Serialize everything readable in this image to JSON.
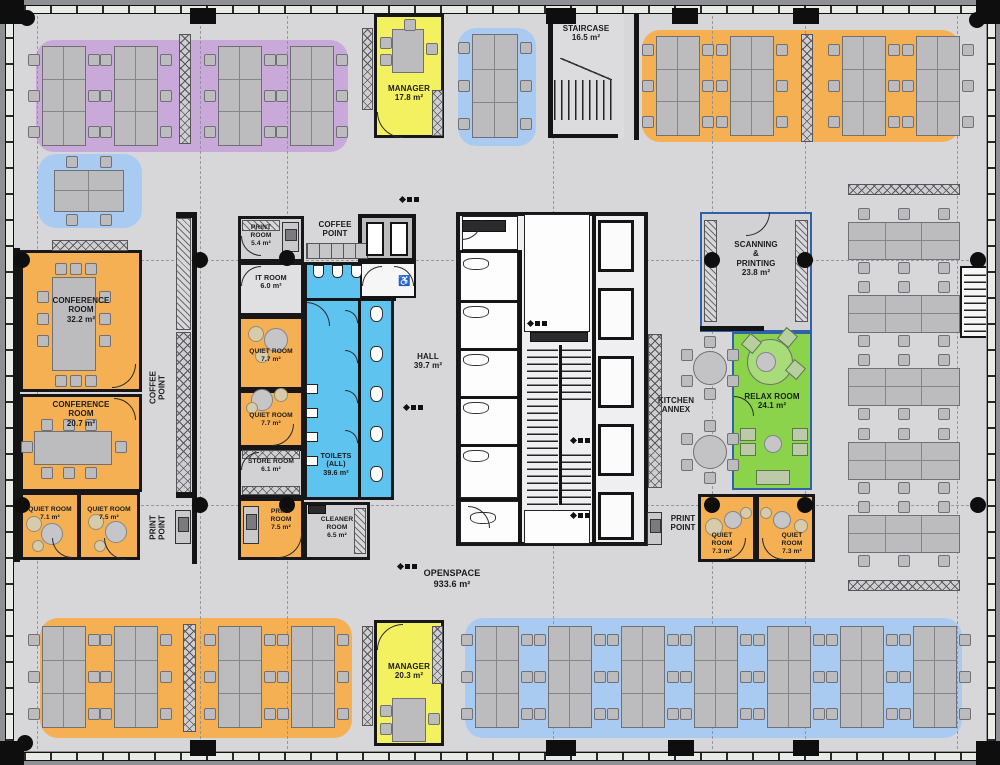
{
  "title": "Office floor plan",
  "colors": {
    "floor": "#d7d7da",
    "wall": "#141414",
    "orange": "#f5b053",
    "purple": "#c9a9da",
    "blue_zone": "#aacbf1",
    "toilet_blue": "#5ec3ee",
    "yellow": "#f4f161",
    "green": "#8bd34b",
    "desk": "#bcbcbf",
    "blue_border": "#2f62ac"
  },
  "rooms": {
    "manager_top": "MANAGER\n17.8 m²",
    "staircase": "STAIRCASE\n16.5 m²",
    "conference_1": "CONFERENCE\nROOM\n32.2 m²",
    "conference_2": "CONFERENCE\nROOM\n20.7 m²",
    "quiet_71": "QUIET ROOM\n7.1 m²",
    "quiet_75": "QUIET ROOM\n7.5 m²",
    "coffee_point_left": "COFFEE\nPOINT",
    "print_point_left": "PRINT\nPOINT",
    "print_room_top": "PRINT\nROOM\n5.4 m²",
    "coffee_point_mid": "COFFEE\nPOINT",
    "it_room": "IT ROOM\n6.0 m²",
    "quiet_77a": "QUIET ROOM\n7.7 m²",
    "quiet_77b": "QUIET ROOM\n7.7 m²",
    "store_room": "STORE ROOM\n6.1 m²",
    "print_room_mid": "PRINT\nROOM\n7.5 m²",
    "cleaner_room": "CLEANER\nROOM\n6.5 m²",
    "toilets": "TOILETS\n(ALL)\n39.6 m²",
    "hall": "HALL\n39.7 m²",
    "scanning_printing": "SCANNING\n&\nPRINTING\n23.8 m²",
    "kitchen_annex": "KITCHEN\nANNEX",
    "relax_room": "RELAX ROOM\n24.1 m²",
    "quiet_73a": "QUIET\nROOM\n7.3 m²",
    "quiet_73b": "QUIET\nROOM\n7.3 m²",
    "print_point_right": "PRINT\nPOINT",
    "openspace": "OPENSPACE\n933.6 m²",
    "manager_bottom": "MANAGER\n20.3 m²"
  },
  "zones": [
    {
      "x": 36,
      "y": 40,
      "w": 312,
      "h": 112,
      "c": "#c9a9da"
    },
    {
      "x": 38,
      "y": 154,
      "w": 104,
      "h": 74,
      "c": "#aacbf1"
    },
    {
      "x": 458,
      "y": 28,
      "w": 78,
      "h": 118,
      "c": "#aacbf1"
    },
    {
      "x": 642,
      "y": 30,
      "w": 318,
      "h": 112,
      "c": "#f5b053"
    },
    {
      "x": 40,
      "y": 618,
      "w": 312,
      "h": 120,
      "c": "#f5b053"
    },
    {
      "x": 465,
      "y": 618,
      "w": 497,
      "h": 120,
      "c": "#aacbf1"
    }
  ],
  "furniture": {
    "desk_clusters": [
      {
        "x": 42,
        "y": 46,
        "w": 44,
        "h": 100,
        "t": "v"
      },
      {
        "x": 114,
        "y": 46,
        "w": 44,
        "h": 100,
        "t": "v"
      },
      {
        "x": 218,
        "y": 46,
        "w": 44,
        "h": 100,
        "t": "v"
      },
      {
        "x": 290,
        "y": 46,
        "w": 44,
        "h": 100,
        "t": "v"
      },
      {
        "x": 472,
        "y": 34,
        "w": 46,
        "h": 104,
        "t": "v"
      },
      {
        "x": 656,
        "y": 36,
        "w": 44,
        "h": 100,
        "t": "v"
      },
      {
        "x": 730,
        "y": 36,
        "w": 44,
        "h": 100,
        "t": "v"
      },
      {
        "x": 842,
        "y": 36,
        "w": 44,
        "h": 100,
        "t": "v"
      },
      {
        "x": 916,
        "y": 36,
        "w": 44,
        "h": 100,
        "t": "v"
      },
      {
        "x": 54,
        "y": 170,
        "w": 70,
        "h": 42,
        "t": "m"
      },
      {
        "x": 848,
        "y": 222,
        "w": 112,
        "h": 38,
        "t": "h"
      },
      {
        "x": 848,
        "y": 295,
        "w": 112,
        "h": 38,
        "t": "h"
      },
      {
        "x": 848,
        "y": 368,
        "w": 112,
        "h": 38,
        "t": "h"
      },
      {
        "x": 848,
        "y": 442,
        "w": 112,
        "h": 38,
        "t": "h"
      },
      {
        "x": 848,
        "y": 515,
        "w": 112,
        "h": 38,
        "t": "h"
      },
      {
        "x": 42,
        "y": 626,
        "w": 44,
        "h": 102,
        "t": "v"
      },
      {
        "x": 114,
        "y": 626,
        "w": 44,
        "h": 102,
        "t": "v"
      },
      {
        "x": 218,
        "y": 626,
        "w": 44,
        "h": 102,
        "t": "v"
      },
      {
        "x": 291,
        "y": 626,
        "w": 44,
        "h": 102,
        "t": "v"
      },
      {
        "x": 475,
        "y": 626,
        "w": 44,
        "h": 102,
        "t": "v"
      },
      {
        "x": 548,
        "y": 626,
        "w": 44,
        "h": 102,
        "t": "v"
      },
      {
        "x": 621,
        "y": 626,
        "w": 44,
        "h": 102,
        "t": "v"
      },
      {
        "x": 694,
        "y": 626,
        "w": 44,
        "h": 102,
        "t": "v"
      },
      {
        "x": 767,
        "y": 626,
        "w": 44,
        "h": 102,
        "t": "v"
      },
      {
        "x": 840,
        "y": 626,
        "w": 44,
        "h": 102,
        "t": "v"
      },
      {
        "x": 913,
        "y": 626,
        "w": 44,
        "h": 102,
        "t": "v"
      }
    ],
    "cabinets": [
      [
        179,
        34,
        12,
        110,
        "x"
      ],
      [
        801,
        34,
        12,
        108,
        "x"
      ],
      [
        183,
        624,
        13,
        108,
        "x"
      ],
      [
        52,
        240,
        76,
        11,
        "x"
      ],
      [
        176,
        218,
        15,
        112,
        "d"
      ],
      [
        176,
        332,
        15,
        164,
        "x"
      ],
      [
        242,
        220,
        38,
        11,
        "d"
      ],
      [
        242,
        450,
        58,
        9,
        "x"
      ],
      [
        242,
        486,
        58,
        9,
        "x"
      ],
      [
        354,
        508,
        12,
        46,
        "d"
      ],
      [
        362,
        28,
        11,
        82,
        "x"
      ],
      [
        432,
        90,
        11,
        46,
        "x"
      ],
      [
        704,
        220,
        13,
        102,
        "d"
      ],
      [
        795,
        220,
        13,
        102,
        "d"
      ],
      [
        648,
        334,
        14,
        154,
        "x"
      ],
      [
        848,
        184,
        112,
        11,
        "x"
      ],
      [
        848,
        580,
        112,
        11,
        "x"
      ],
      [
        362,
        626,
        11,
        100,
        "x"
      ],
      [
        432,
        626,
        11,
        58,
        "x"
      ]
    ],
    "counters": [
      [
        306,
        243,
        62,
        16
      ]
    ],
    "tables": [
      [
        52,
        277,
        44,
        94
      ],
      [
        34,
        431,
        78,
        34
      ],
      [
        392,
        29,
        32,
        44
      ],
      [
        392,
        698,
        34,
        44
      ]
    ],
    "chairs": [
      [
        55,
        263
      ],
      [
        70,
        263
      ],
      [
        85,
        263
      ],
      [
        55,
        375
      ],
      [
        70,
        375
      ],
      [
        85,
        375
      ],
      [
        37,
        291
      ],
      [
        37,
        313
      ],
      [
        37,
        335
      ],
      [
        99,
        291
      ],
      [
        99,
        313
      ],
      [
        99,
        335
      ],
      [
        41,
        419
      ],
      [
        63,
        419
      ],
      [
        85,
        419
      ],
      [
        41,
        467
      ],
      [
        63,
        467
      ],
      [
        85,
        467
      ],
      [
        21,
        441
      ],
      [
        115,
        441
      ],
      [
        380,
        37
      ],
      [
        380,
        54
      ],
      [
        426,
        43
      ],
      [
        404,
        19
      ],
      [
        380,
        705
      ],
      [
        380,
        723
      ],
      [
        428,
        713
      ]
    ],
    "round_tables": [
      {
        "cx": 710,
        "cy": 368,
        "r": 17,
        "n": 6,
        "c": "#c3c3c6"
      },
      {
        "cx": 710,
        "cy": 452,
        "r": 17,
        "n": 6,
        "c": "#c3c3c6"
      },
      {
        "cx": 770,
        "cy": 362,
        "r": 23,
        "n": 0,
        "c": "#a7dc78"
      }
    ],
    "poufs": [
      [
        34,
        524,
        8,
        "b"
      ],
      [
        52,
        534,
        11,
        "g"
      ],
      [
        38,
        546,
        6,
        "b"
      ],
      [
        96,
        522,
        8,
        "b"
      ],
      [
        116,
        532,
        11,
        "g"
      ],
      [
        100,
        546,
        6,
        "b"
      ],
      [
        256,
        334,
        8,
        "b"
      ],
      [
        276,
        340,
        12,
        "g"
      ],
      [
        262,
        356,
        7,
        "b"
      ],
      [
        262,
        400,
        11,
        "g"
      ],
      [
        281,
        395,
        7,
        "b"
      ],
      [
        252,
        408,
        6,
        "b"
      ],
      [
        733,
        520,
        9,
        "g"
      ],
      [
        746,
        513,
        6,
        "b"
      ],
      [
        714,
        527,
        9,
        "b"
      ],
      [
        766,
        513,
        6,
        "b"
      ],
      [
        782,
        520,
        9,
        "g"
      ],
      [
        801,
        526,
        7,
        "b"
      ],
      [
        766,
        362,
        10,
        "g"
      ],
      [
        773,
        444,
        9,
        "g"
      ]
    ],
    "rot_squares": [
      [
        744,
        336
      ],
      [
        780,
        330
      ],
      [
        788,
        362
      ]
    ],
    "seats": [
      [
        740,
        428,
        16,
        13
      ],
      [
        740,
        443,
        16,
        13
      ],
      [
        792,
        428,
        16,
        13
      ],
      [
        792,
        443,
        16,
        13
      ],
      [
        756,
        470,
        34,
        15
      ]
    ],
    "printers": [
      [
        175,
        510,
        16,
        34
      ],
      [
        282,
        222,
        17,
        30
      ],
      [
        243,
        506,
        16,
        38
      ],
      [
        647,
        512,
        15,
        33
      ]
    ],
    "urinals": [
      [
        313,
        265
      ],
      [
        332,
        265
      ],
      [
        351,
        265
      ]
    ],
    "basins": [
      [
        306,
        384
      ],
      [
        306,
        408
      ],
      [
        306,
        432
      ],
      [
        306,
        456
      ]
    ],
    "wcs": [
      [
        370,
        306,
        "v"
      ],
      [
        370,
        346,
        "v"
      ],
      [
        370,
        386,
        "v"
      ],
      [
        370,
        426,
        "v"
      ],
      [
        370,
        466,
        "v"
      ],
      [
        463,
        306,
        "h"
      ],
      [
        463,
        354,
        "h"
      ],
      [
        463,
        402,
        "h"
      ],
      [
        463,
        450,
        "h"
      ],
      [
        463,
        258,
        "h"
      ],
      [
        470,
        512,
        "h"
      ]
    ]
  },
  "plan_graphics": {
    "walls": [
      [
        548,
        14,
        5,
        124
      ],
      [
        548,
        134,
        70,
        4
      ],
      [
        634,
        14,
        5,
        126
      ],
      [
        14,
        248,
        6,
        314
      ],
      [
        192,
        212,
        5,
        352
      ],
      [
        176,
        212,
        21,
        6
      ],
      [
        176,
        492,
        21,
        6
      ],
      [
        304,
        298,
        92,
        3
      ],
      [
        358,
        300,
        3,
        198
      ],
      [
        518,
        252,
        4,
        294
      ],
      [
        592,
        212,
        4,
        334
      ],
      [
        460,
        250,
        62,
        3
      ],
      [
        460,
        300,
        58,
        3
      ],
      [
        460,
        348,
        58,
        3
      ],
      [
        460,
        396,
        58,
        3
      ],
      [
        460,
        444,
        58,
        3
      ],
      [
        456,
        498,
        62,
        3
      ],
      [
        559,
        345,
        3,
        160
      ],
      [
        700,
        326,
        64,
        5
      ]
    ],
    "white_rects": [
      [
        460,
        252,
        58,
        246
      ],
      [
        462,
        216,
        56,
        34
      ],
      [
        460,
        501,
        60,
        42
      ],
      [
        524,
        214,
        66,
        118
      ],
      [
        524,
        510,
        66,
        34
      ]
    ],
    "lifts": [
      [
        598,
        220,
        36,
        52
      ],
      [
        598,
        288,
        36,
        52
      ],
      [
        598,
        356,
        36,
        52
      ],
      [
        598,
        424,
        36,
        52
      ],
      [
        598,
        492,
        36,
        48
      ]
    ],
    "stairs": [
      [
        554,
        80,
        62,
        40,
        "v"
      ],
      [
        527,
        345,
        31,
        160,
        "h"
      ],
      [
        562,
        345,
        29,
        55,
        "h"
      ],
      [
        562,
        450,
        29,
        55,
        "h"
      ]
    ],
    "dark_rects": [
      [
        530,
        332,
        58,
        10
      ],
      [
        462,
        220,
        44,
        12
      ],
      [
        308,
        505,
        18,
        9
      ]
    ],
    "arcs": [
      {
        "x": 377,
        "y": 112,
        "r": 26,
        "q": "bl"
      },
      {
        "x": 377,
        "y": 624,
        "r": 26,
        "q": "tl"
      },
      {
        "x": 112,
        "y": 364,
        "r": 24,
        "q": "br"
      },
      {
        "x": 114,
        "y": 398,
        "r": 22,
        "q": "tr"
      },
      {
        "x": 52,
        "y": 538,
        "r": 20,
        "q": "bl"
      },
      {
        "x": 104,
        "y": 538,
        "r": 22,
        "q": "bl"
      },
      {
        "x": 241,
        "y": 236,
        "r": 20,
        "q": "bl"
      },
      {
        "x": 241,
        "y": 266,
        "r": 20,
        "q": "tl"
      },
      {
        "x": 272,
        "y": 424,
        "r": 22,
        "q": "br"
      },
      {
        "x": 241,
        "y": 452,
        "r": 18,
        "q": "tl"
      },
      {
        "x": 278,
        "y": 534,
        "r": 24,
        "q": "br"
      },
      {
        "x": 306,
        "y": 302,
        "r": 24,
        "q": "tr"
      },
      {
        "x": 362,
        "y": 266,
        "r": 20,
        "q": "tl"
      },
      {
        "x": 394,
        "y": 266,
        "r": 20,
        "q": "tr"
      },
      {
        "x": 345,
        "y": 310,
        "r": 13,
        "q": "tr"
      },
      {
        "x": 345,
        "y": 350,
        "r": 13,
        "q": "tr"
      },
      {
        "x": 345,
        "y": 390,
        "r": 13,
        "q": "tr"
      },
      {
        "x": 345,
        "y": 430,
        "r": 13,
        "q": "tr"
      },
      {
        "x": 462,
        "y": 220,
        "r": 20,
        "q": "br"
      },
      {
        "x": 468,
        "y": 506,
        "r": 22,
        "q": "tr"
      },
      {
        "x": 746,
        "y": 212,
        "r": 24,
        "q": "br"
      },
      {
        "x": 734,
        "y": 396,
        "r": 20,
        "q": "tr"
      },
      {
        "x": 724,
        "y": 538,
        "r": 22,
        "q": "br"
      },
      {
        "x": 762,
        "y": 538,
        "r": 22,
        "q": "bl"
      }
    ],
    "symbols": [
      [
        400,
        196
      ],
      [
        404,
        404
      ],
      [
        398,
        563
      ],
      [
        528,
        320
      ],
      [
        571,
        437
      ],
      [
        571,
        512
      ]
    ]
  },
  "structure": {
    "grid_v": [
      37,
      200,
      287,
      553,
      712,
      805,
      957
    ],
    "grid_h": [
      260,
      505
    ],
    "columns": [
      [
        22,
        260
      ],
      [
        200,
        260
      ],
      [
        287,
        258
      ],
      [
        712,
        260
      ],
      [
        805,
        260
      ],
      [
        978,
        260
      ],
      [
        22,
        505
      ],
      [
        200,
        505
      ],
      [
        287,
        505
      ],
      [
        712,
        505
      ],
      [
        805,
        505
      ],
      [
        978,
        505
      ],
      [
        27,
        18
      ],
      [
        977,
        20
      ],
      [
        25,
        743
      ]
    ],
    "piers": [
      [
        190,
        8,
        26,
        16
      ],
      [
        546,
        8,
        30,
        16
      ],
      [
        672,
        8,
        26,
        16
      ],
      [
        793,
        8,
        26,
        16
      ],
      [
        190,
        740,
        26,
        16
      ],
      [
        546,
        740,
        30,
        16
      ],
      [
        668,
        740,
        26,
        16
      ],
      [
        793,
        740,
        26,
        16
      ],
      [
        0,
        0,
        24,
        24
      ],
      [
        976,
        0,
        24,
        24
      ],
      [
        0,
        741,
        24,
        24
      ],
      [
        976,
        741,
        24,
        24
      ]
    ]
  }
}
